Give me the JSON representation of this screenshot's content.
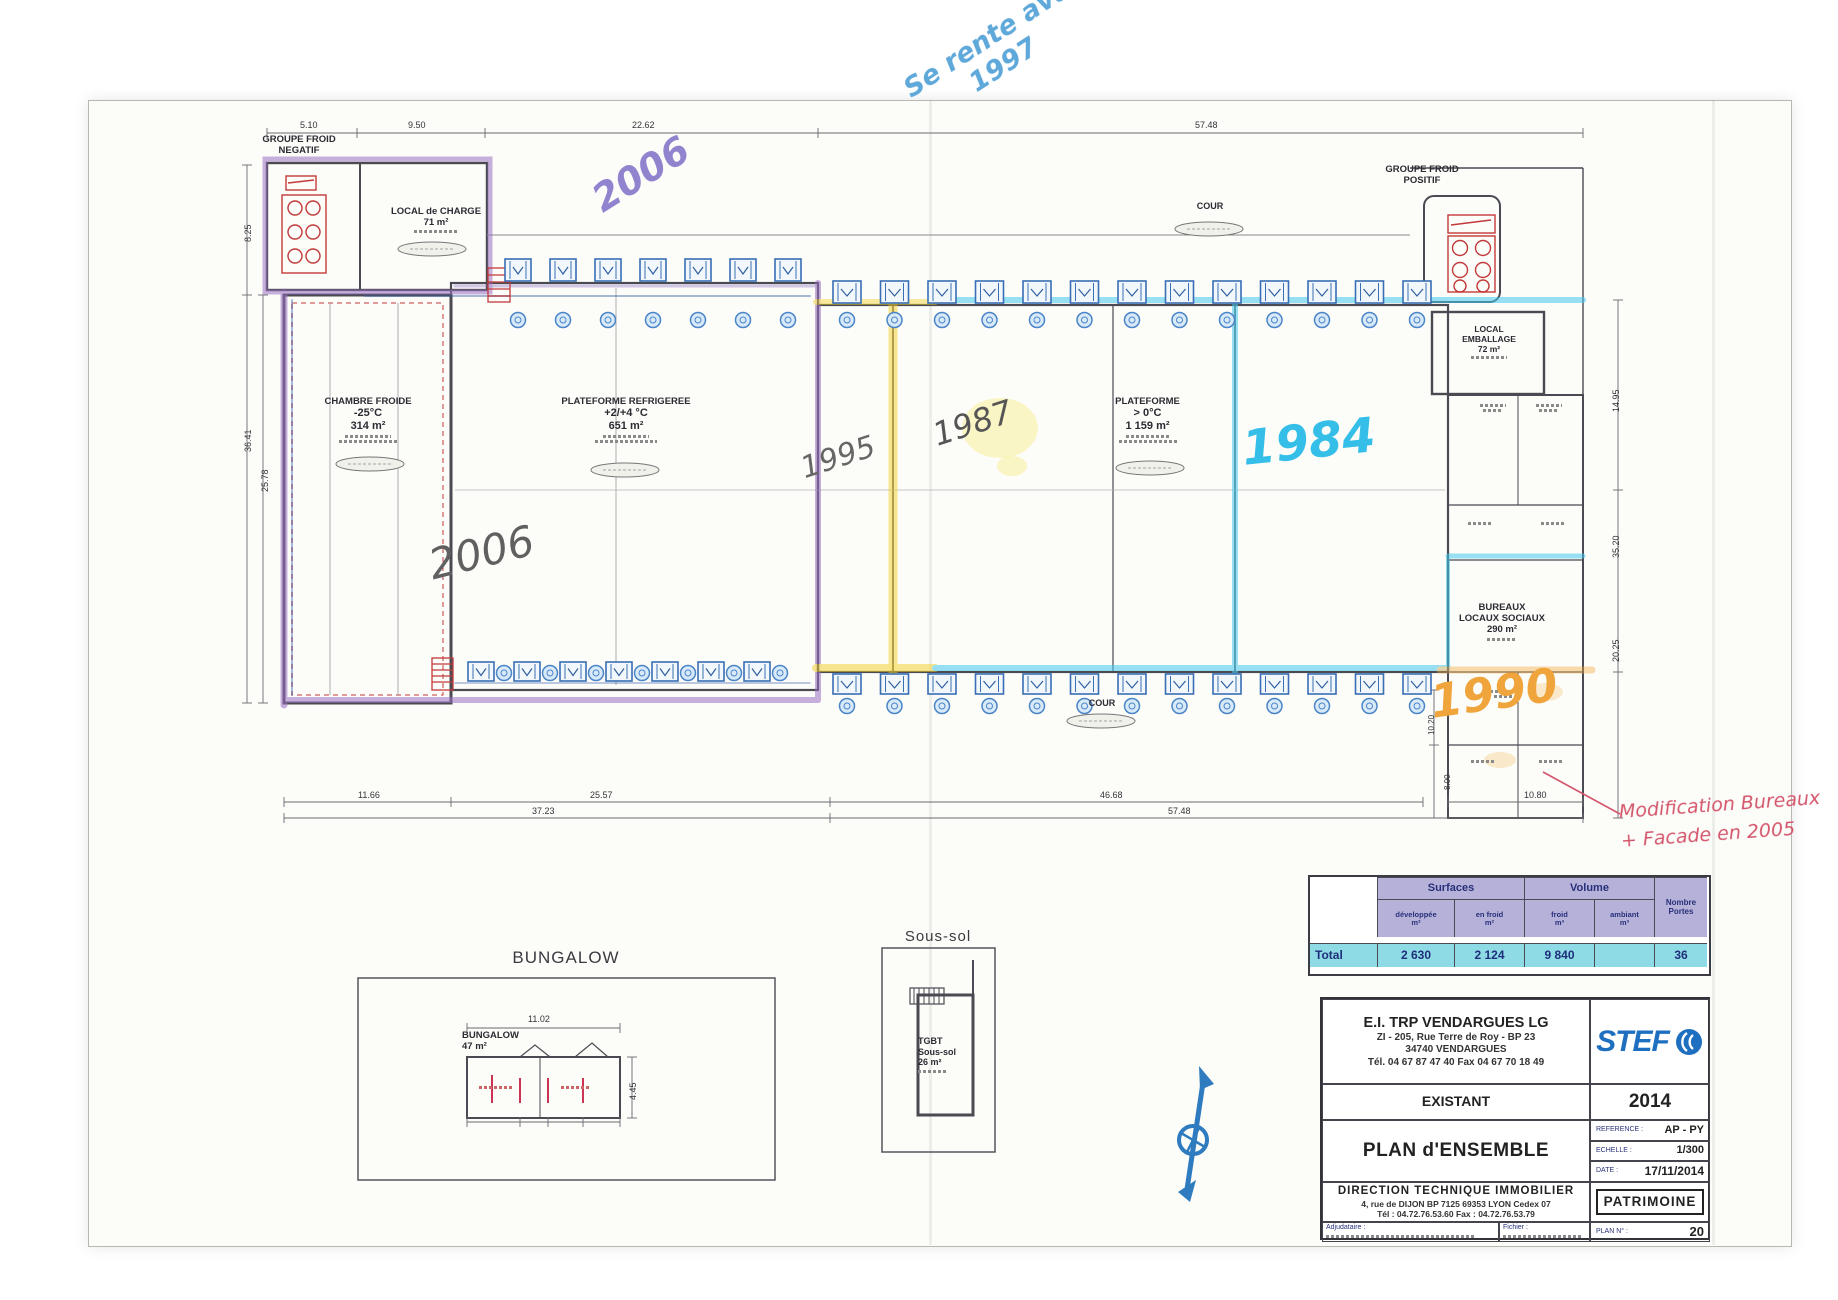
{
  "colors": {
    "highlight_purple": "#9b6fc4",
    "highlight_yellow": "#f2d024",
    "highlight_cyan": "#44c8ef",
    "highlight_orange": "#f2a93b",
    "marker_blue": "#5fa8da",
    "marker_lilac": "#9283cf",
    "pen_red": "#d4566c",
    "pencil_gray": "#5f5f5f",
    "table_header": "#b6b1d8",
    "table_total": "#8edbe6",
    "stef_blue": "#1e6fc0"
  },
  "plan": {
    "groupe_froid_negatif": {
      "l1": "GROUPE FROID",
      "l2": "NEGATIF"
    },
    "groupe_froid_positif": {
      "l1": "GROUPE FROID",
      "l2": "POSITIF"
    },
    "local_charge": {
      "l1": "LOCAL de CHARGE",
      "l2": "71 m²"
    },
    "chambre_froide": {
      "l1": "CHAMBRE FROIDE",
      "l2": "-25°C",
      "l3": "314 m²"
    },
    "plateforme_refrigeree": {
      "l1": "PLATEFORME REFRIGEREE",
      "l2": "+2/+4 °C",
      "l3": "651 m²"
    },
    "plateforme_positive": {
      "l1": "PLATEFORME",
      "l2": "> 0°C",
      "l3": "1 159 m²"
    },
    "local_emballage": {
      "l1": "LOCAL",
      "l2": "EMBALLAGE",
      "l3": "72 m²"
    },
    "bureaux": {
      "l1": "BUREAUX",
      "l2": "LOCAUX SOCIAUX",
      "l3": "290 m²"
    },
    "cour": "COUR",
    "docks": {
      "rows": [
        7,
        13,
        7,
        13
      ]
    }
  },
  "annotations": {
    "purple_2006": "2006",
    "pencil_2006": "2006",
    "blue_note_l1": "Se rente avant",
    "blue_note_l2": "1997",
    "pencil_1995": "1995",
    "pencil_1987": "1987",
    "cyan_1984": "1984",
    "orange_1990": "1990",
    "red_note_l1": "Modification Bureaux",
    "red_note_l2": "+ Facade en 2005"
  },
  "dimensions": {
    "top": [
      "5.10",
      "9.50",
      "22.62",
      "57.48"
    ],
    "bottom1": [
      "11.66",
      "25.57",
      "46.68",
      "10.80"
    ],
    "bottom2": [
      "37.23",
      "57.48"
    ],
    "left": [
      "8.25",
      "36.41",
      "25.78"
    ],
    "right": [
      "14.95",
      "35.20",
      "20.25"
    ],
    "right_inner": [
      "10.20",
      "8.00"
    ],
    "bungalow_w": "11.02",
    "bungalow_h": "4.45"
  },
  "bungalow": {
    "heading": "BUNGALOW",
    "l1": "BUNGALOW",
    "l2": "47 m²"
  },
  "sous_sol": {
    "heading": "Sous-sol",
    "l1": "TGBT",
    "l2": "Sous-sol",
    "l3": "26 m²"
  },
  "table": {
    "surfaces": "Surfaces",
    "volume": "Volume",
    "portes_l1": "Nombre",
    "portes_l2": "Portes",
    "c1l1": "développée",
    "c1l2": "m²",
    "c2l1": "en froid",
    "c2l2": "m²",
    "c3l1": "froid",
    "c3l2": "m³",
    "c4l1": "ambiant",
    "c4l2": "m³",
    "total": "Total",
    "v1": "2 630",
    "v2": "2 124",
    "v3": "9 840",
    "v4": "",
    "v5": "36"
  },
  "title_block": {
    "company_name": "E.I. TRP VENDARGUES LG",
    "address1": "ZI -  205, Rue Terre de Roy - BP 23",
    "address2": "34740   VENDARGUES",
    "phone": "Tél. 04 67 87 47 40  Fax 04 67 70 18 49",
    "logo": "STEF",
    "status": "EXISTANT",
    "year": "2014",
    "title": "PLAN d'ENSEMBLE",
    "reference_label": "REFERENCE :",
    "reference": "AP - PY",
    "scale_label": "ECHELLE :",
    "scale": "1/300",
    "date_label": "DATE :",
    "date": "17/11/2014",
    "dept1": "DIRECTION TECHNIQUE IMMOBILIER",
    "dept2": "4, rue de DIJON BP 7125   69353 LYON Cedex 07",
    "dept3": "Tél : 04.72.76.53.60      Fax : 04.72.76.53.79",
    "stamp": "PATRIMOINE",
    "adj_label": "Adjudataire :",
    "file_label": "Fichier :",
    "plan_no_label": "PLAN N° :",
    "plan_no": "20"
  }
}
